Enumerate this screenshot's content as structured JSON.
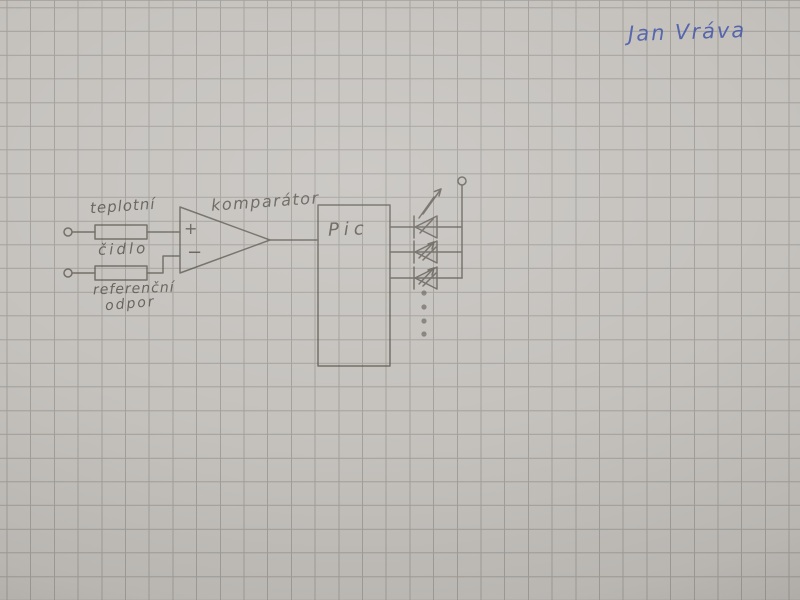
{
  "signature": {
    "name": "Jan Vráva"
  },
  "labels": {
    "sensor_line1": "teplotní",
    "sensor_line2": "čidlo",
    "reference_line1": "referenční",
    "reference_line2": "odpor",
    "comparator": "komparátor",
    "mcu": "Pic",
    "plus_input": "+",
    "minus_input": "−"
  },
  "colors": {
    "paper": "#c5c2be",
    "grid-line": "#a3a09b",
    "pencil": "#57524a",
    "ink": "#4a5cab"
  },
  "diagram": {
    "kind": "hand-drawn schematic on squared paper",
    "components": [
      {
        "id": "input-terminal-top",
        "type": "open terminal"
      },
      {
        "id": "resistor-sensor",
        "type": "resistor",
        "label": "teplotní čidlo"
      },
      {
        "id": "input-terminal-bottom",
        "type": "open terminal"
      },
      {
        "id": "resistor-reference",
        "type": "resistor",
        "label": "referenční odpor"
      },
      {
        "id": "comparator",
        "type": "comparator (op-amp triangle, + and − inputs)",
        "label": "komparátor"
      },
      {
        "id": "mcu-block",
        "type": "rectangular block",
        "label": "Pic"
      },
      {
        "id": "led-1",
        "type": "LED with emission arrows"
      },
      {
        "id": "led-2",
        "type": "LED with emission arrows"
      },
      {
        "id": "led-3",
        "type": "LED with emission arrows"
      },
      {
        "id": "more-outputs-dots",
        "type": "ellipsis dots (more LED outputs)"
      },
      {
        "id": "supply-terminal",
        "type": "open terminal on vertical rail"
      }
    ]
  }
}
